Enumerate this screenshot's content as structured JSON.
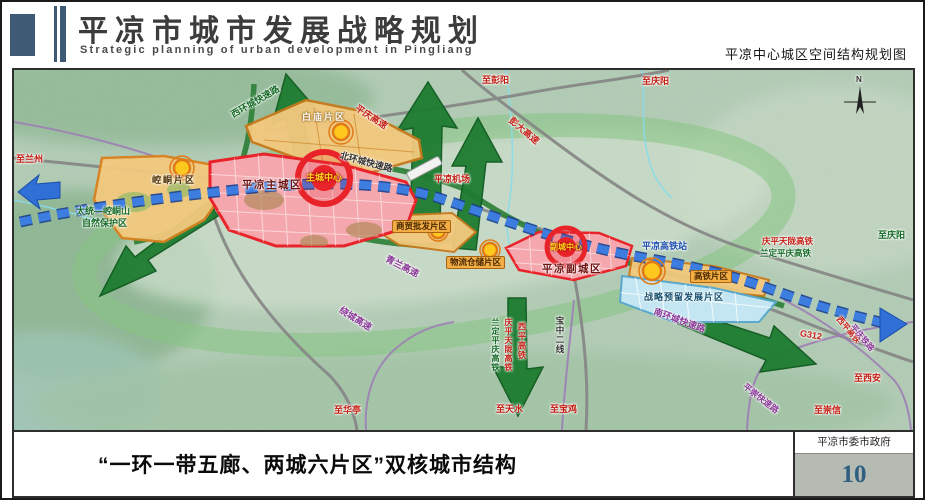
{
  "header": {
    "title": "平凉市城市发展战略规划",
    "subtitle": "Strategic planning of urban development in Pingliang",
    "map_title": "平凉中心城区空间结构规划图"
  },
  "map": {
    "compass": "N",
    "areas": {
      "zhucheng": "平凉主城区",
      "fucheng": "平凉副城区",
      "kongtong": "崆峒片区",
      "baimiao": "白庙片区",
      "shangmao": "商贸批发片区",
      "wuliu": "物流仓储片区",
      "gaotie": "高铁片区",
      "zhanlue": "战略预留发展片区",
      "core_main": "主城中心",
      "core_sub": "副城中心",
      "reserve_line1": "太统—崆峒山",
      "reserve_line2": "自然保护区"
    },
    "roads": {
      "xihuan": "西环城快速路",
      "beihuan": "北环城快速路",
      "nanhuan": "南环城快速路",
      "raocheng": "绕城高速",
      "pingqing_gs": "平庆高速",
      "pengda_gs": "彭大高速",
      "qinglan_gs": "青兰高速",
      "g312": "G312",
      "pingchong": "平崇快速路",
      "qptl_hsr": "庆平天陇高铁",
      "ldpq_hsr": "兰定平庆高铁",
      "xiping_hsr": "西平高铁",
      "pingqing_rail": "平庆铁路",
      "baozhong": "宝中二线",
      "station": "平凉高铁站",
      "airport": "平凉机场"
    },
    "directions": {
      "lanzhou": "至兰州",
      "pengyang": "至彭阳",
      "qingyang_top": "至庆阳",
      "qingyang_right": "至庆阳",
      "xian": "至西安",
      "chongxin": "至崇信",
      "baoji": "至宝鸡",
      "tianshui": "至天水",
      "huating": "至华亭"
    }
  },
  "footer": {
    "caption": "“一环一带五廊、两城六片区”双核城市结构",
    "agency": "平凉市委市政府",
    "page": "10"
  },
  "colors": {
    "accent_blue": "#3e5a74",
    "belt_blue": "#2f6fd6",
    "corridor_green": "#1e7c31",
    "city_red": "#e8242a",
    "district_orange": "#d9821f",
    "reserved_blue": "#5aa8cc"
  }
}
